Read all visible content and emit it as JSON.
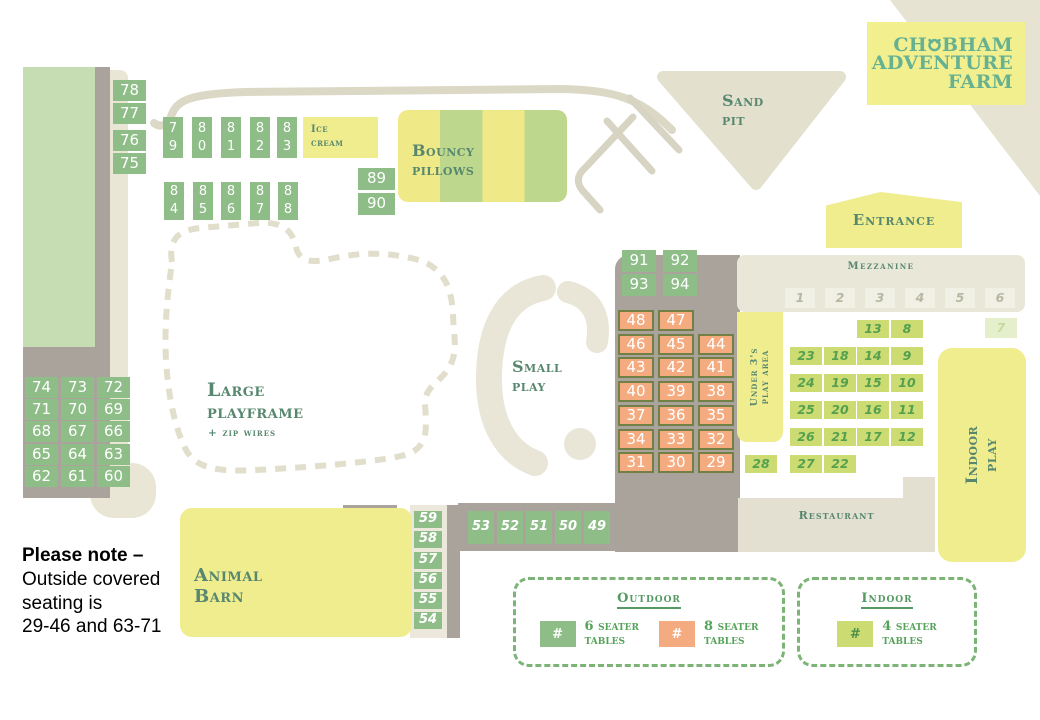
{
  "logo": {
    "pre": "Ch",
    "post": "bham",
    "line2": "Adventure",
    "line3": "Farm"
  },
  "labels": {
    "ice_cream": "Ice\ncream",
    "bouncy_pillows": "Bouncy\npillows",
    "sand_pit": "Sand\npit",
    "entrance": "Entrance",
    "mezzanine": "Mezzanine",
    "large_playframe": "Large\nplayframe",
    "zip_wires": "+ zip wires",
    "small_play": "Small\nplay",
    "under_3s": "Under 3's\nplay area",
    "indoor_play": "Indoor\nplay",
    "restaurant": "Restaurant",
    "animal_barn": "Animal\nBarn"
  },
  "note": {
    "title": "Please note –",
    "line1": "Outside covered",
    "line2": "seating is",
    "line3": "29-46 and 63-71"
  },
  "legend": {
    "outdoor_title": "Outdoor",
    "indoor_title": "Indoor",
    "items": [
      {
        "swatch": "green",
        "symbol": "#",
        "label": "6 seater\ntables"
      },
      {
        "swatch": "orange",
        "symbol": "#",
        "label": "8 seater\ntables"
      },
      {
        "swatch": "lime",
        "symbol": "#",
        "label": "4 seater\ntables"
      }
    ]
  },
  "colors": {
    "outdoor_6_seater": "#8ebd88",
    "outdoor_8_seater": "#f5ab80",
    "indoor_4_seater": "#ccdc73",
    "zone_yellow": "#f0ed8e",
    "building_grey": "#a9a39c",
    "path_beige": "#e3e0d1",
    "label_green": "#57886f",
    "logo_green": "#66b191",
    "field_green": "#c6ddb4"
  },
  "table_groups": [
    {
      "name": "outdoor-6-seater",
      "kind": "green",
      "w": 33,
      "h": 21,
      "items": [
        {
          "n": "78",
          "x": 113,
          "y": 80
        },
        {
          "n": "77",
          "x": 113,
          "y": 103
        },
        {
          "n": "76",
          "x": 113,
          "y": 130
        },
        {
          "n": "75",
          "x": 113,
          "y": 153
        },
        {
          "n": "79",
          "x": 163,
          "y": 117,
          "w": 20,
          "h": 41,
          "stack": true
        },
        {
          "n": "80",
          "x": 192,
          "y": 117,
          "w": 20,
          "h": 41,
          "stack": true
        },
        {
          "n": "81",
          "x": 221,
          "y": 117,
          "w": 20,
          "h": 41,
          "stack": true
        },
        {
          "n": "82",
          "x": 250,
          "y": 117,
          "w": 20,
          "h": 41,
          "stack": true
        },
        {
          "n": "83",
          "x": 277,
          "y": 117,
          "w": 20,
          "h": 41,
          "stack": true
        },
        {
          "n": "84",
          "x": 164,
          "y": 182,
          "w": 20,
          "h": 38,
          "stack": true
        },
        {
          "n": "85",
          "x": 193,
          "y": 182,
          "w": 20,
          "h": 38,
          "stack": true
        },
        {
          "n": "86",
          "x": 221,
          "y": 182,
          "w": 20,
          "h": 38,
          "stack": true
        },
        {
          "n": "87",
          "x": 250,
          "y": 182,
          "w": 20,
          "h": 38,
          "stack": true
        },
        {
          "n": "88",
          "x": 278,
          "y": 182,
          "w": 20,
          "h": 38,
          "stack": true
        },
        {
          "n": "89",
          "x": 358,
          "y": 168,
          "w": 37,
          "h": 22
        },
        {
          "n": "90",
          "x": 358,
          "y": 193,
          "w": 37,
          "h": 22
        },
        {
          "n": "74",
          "x": 25,
          "y": 377
        },
        {
          "n": "73",
          "x": 61,
          "y": 377
        },
        {
          "n": "72",
          "x": 97,
          "y": 377
        },
        {
          "n": "71",
          "x": 25,
          "y": 399
        },
        {
          "n": "70",
          "x": 61,
          "y": 399
        },
        {
          "n": "69",
          "x": 97,
          "y": 399
        },
        {
          "n": "68",
          "x": 25,
          "y": 421
        },
        {
          "n": "67",
          "x": 61,
          "y": 421
        },
        {
          "n": "66",
          "x": 97,
          "y": 421
        },
        {
          "n": "65",
          "x": 25,
          "y": 444
        },
        {
          "n": "64",
          "x": 61,
          "y": 444
        },
        {
          "n": "63",
          "x": 97,
          "y": 444
        },
        {
          "n": "62",
          "x": 25,
          "y": 466
        },
        {
          "n": "61",
          "x": 61,
          "y": 466
        },
        {
          "n": "60",
          "x": 97,
          "y": 466
        },
        {
          "n": "91",
          "x": 622,
          "y": 250,
          "w": 34,
          "h": 22
        },
        {
          "n": "92",
          "x": 663,
          "y": 250,
          "w": 34,
          "h": 22
        },
        {
          "n": "93",
          "x": 622,
          "y": 274,
          "w": 34,
          "h": 22
        },
        {
          "n": "94",
          "x": 663,
          "y": 274,
          "w": 34,
          "h": 22
        }
      ]
    },
    {
      "name": "outdoor-6-seater-script",
      "kind": "green-script",
      "w": 28,
      "h": 17,
      "items": [
        {
          "n": "59",
          "x": 414,
          "y": 511
        },
        {
          "n": "58",
          "x": 414,
          "y": 531
        },
        {
          "n": "57",
          "x": 414,
          "y": 552
        },
        {
          "n": "56",
          "x": 414,
          "y": 572
        },
        {
          "n": "55",
          "x": 414,
          "y": 592
        },
        {
          "n": "54",
          "x": 414,
          "y": 612
        },
        {
          "n": "53",
          "x": 468,
          "y": 511,
          "w": 26,
          "h": 33
        },
        {
          "n": "52",
          "x": 497,
          "y": 511,
          "w": 26,
          "h": 33
        },
        {
          "n": "51",
          "x": 526,
          "y": 511,
          "w": 26,
          "h": 33
        },
        {
          "n": "50",
          "x": 555,
          "y": 511,
          "w": 26,
          "h": 33
        },
        {
          "n": "49",
          "x": 584,
          "y": 511,
          "w": 26,
          "h": 33
        }
      ]
    },
    {
      "name": "outdoor-8-seater",
      "kind": "orange",
      "w": 36,
      "h": 21,
      "items": [
        {
          "n": "48",
          "x": 618,
          "y": 310
        },
        {
          "n": "47",
          "x": 658,
          "y": 310
        },
        {
          "n": "46",
          "x": 618,
          "y": 334
        },
        {
          "n": "45",
          "x": 658,
          "y": 334
        },
        {
          "n": "44",
          "x": 698,
          "y": 334
        },
        {
          "n": "43",
          "x": 618,
          "y": 357
        },
        {
          "n": "42",
          "x": 658,
          "y": 357
        },
        {
          "n": "41",
          "x": 698,
          "y": 357
        },
        {
          "n": "40",
          "x": 618,
          "y": 381
        },
        {
          "n": "39",
          "x": 658,
          "y": 381
        },
        {
          "n": "38",
          "x": 698,
          "y": 381
        },
        {
          "n": "37",
          "x": 618,
          "y": 405
        },
        {
          "n": "36",
          "x": 658,
          "y": 405
        },
        {
          "n": "35",
          "x": 698,
          "y": 405
        },
        {
          "n": "34",
          "x": 618,
          "y": 429
        },
        {
          "n": "33",
          "x": 658,
          "y": 429
        },
        {
          "n": "32",
          "x": 698,
          "y": 429
        },
        {
          "n": "31",
          "x": 618,
          "y": 452
        },
        {
          "n": "30",
          "x": 658,
          "y": 452
        },
        {
          "n": "29",
          "x": 698,
          "y": 452
        }
      ]
    },
    {
      "name": "indoor-4-seater",
      "kind": "lime",
      "w": 32,
      "h": 18,
      "items": [
        {
          "n": "13",
          "x": 857,
          "y": 320
        },
        {
          "n": "8",
          "x": 891,
          "y": 320
        },
        {
          "n": "23",
          "x": 790,
          "y": 347
        },
        {
          "n": "18",
          "x": 824,
          "y": 347
        },
        {
          "n": "14",
          "x": 857,
          "y": 347
        },
        {
          "n": "9",
          "x": 891,
          "y": 347
        },
        {
          "n": "24",
          "x": 790,
          "y": 374
        },
        {
          "n": "19",
          "x": 824,
          "y": 374
        },
        {
          "n": "15",
          "x": 857,
          "y": 374
        },
        {
          "n": "10",
          "x": 891,
          "y": 374
        },
        {
          "n": "25",
          "x": 790,
          "y": 401
        },
        {
          "n": "20",
          "x": 824,
          "y": 401
        },
        {
          "n": "16",
          "x": 857,
          "y": 401
        },
        {
          "n": "11",
          "x": 891,
          "y": 401
        },
        {
          "n": "26",
          "x": 790,
          "y": 428
        },
        {
          "n": "21",
          "x": 824,
          "y": 428
        },
        {
          "n": "17",
          "x": 857,
          "y": 428
        },
        {
          "n": "12",
          "x": 891,
          "y": 428
        },
        {
          "n": "28",
          "x": 745,
          "y": 455
        },
        {
          "n": "27",
          "x": 790,
          "y": 455
        },
        {
          "n": "22",
          "x": 824,
          "y": 455
        }
      ]
    },
    {
      "name": "indoor-4-seater-pale",
      "kind": "pale",
      "w": 32,
      "h": 20,
      "items": [
        {
          "n": "7",
          "x": 985,
          "y": 318
        }
      ]
    },
    {
      "name": "mezzanine-bay",
      "kind": "mezz",
      "w": 30,
      "h": 20,
      "items": [
        {
          "n": "1",
          "x": 785,
          "y": 288
        },
        {
          "n": "2",
          "x": 825,
          "y": 288
        },
        {
          "n": "3",
          "x": 865,
          "y": 288
        },
        {
          "n": "4",
          "x": 905,
          "y": 288
        },
        {
          "n": "5",
          "x": 945,
          "y": 288
        },
        {
          "n": "6",
          "x": 985,
          "y": 288
        }
      ]
    }
  ]
}
